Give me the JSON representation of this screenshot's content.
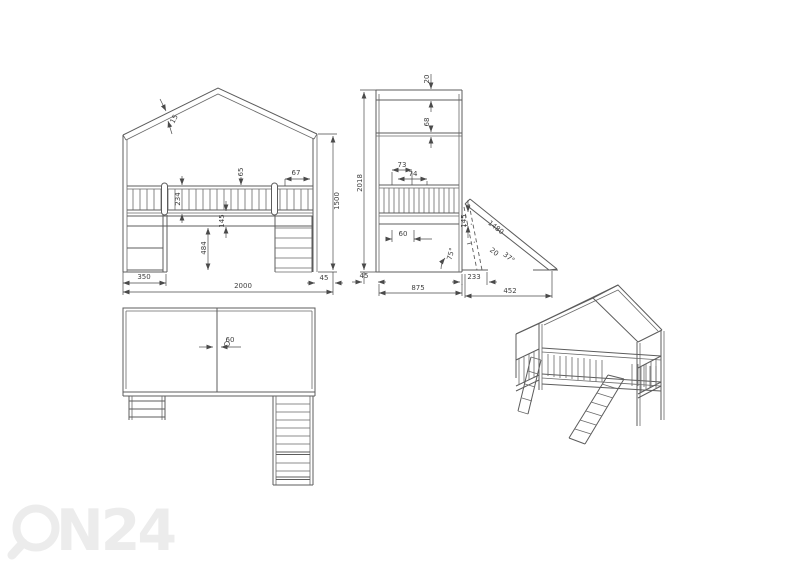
{
  "drawing": {
    "background": "#ffffff",
    "line_color": "#5c5c5c",
    "dimension_color": "#4a4a4a"
  },
  "watermark": {
    "text": "ON24",
    "tail": "N24",
    "color": "#ececec"
  },
  "front_view": {
    "dims": {
      "roof_thickness": "15",
      "rail_cap": "65",
      "rail_gap_right": "67",
      "rail_height": "234",
      "frame_height": "145",
      "under_bed_clearance": "484",
      "ladder_width": "350",
      "overall_width": "2000",
      "post_width": "45",
      "side_height": "1500"
    }
  },
  "side_view": {
    "dims": {
      "ridge_board": "20",
      "roof_beam": "68",
      "overall_height": "2018",
      "slat_pitch_a": "73",
      "slat_pitch_b": "74",
      "frame_height": "145",
      "slat_width": "60",
      "ladder_angle": "75°",
      "slide_length": "1480",
      "slide_thickness": "20",
      "slide_angle": "37°",
      "slide_offset": "233",
      "post_width": "45",
      "overall_depth": "875",
      "slide_run": "452"
    }
  },
  "top_view": {
    "dims": {
      "panel_gap": "60"
    }
  }
}
